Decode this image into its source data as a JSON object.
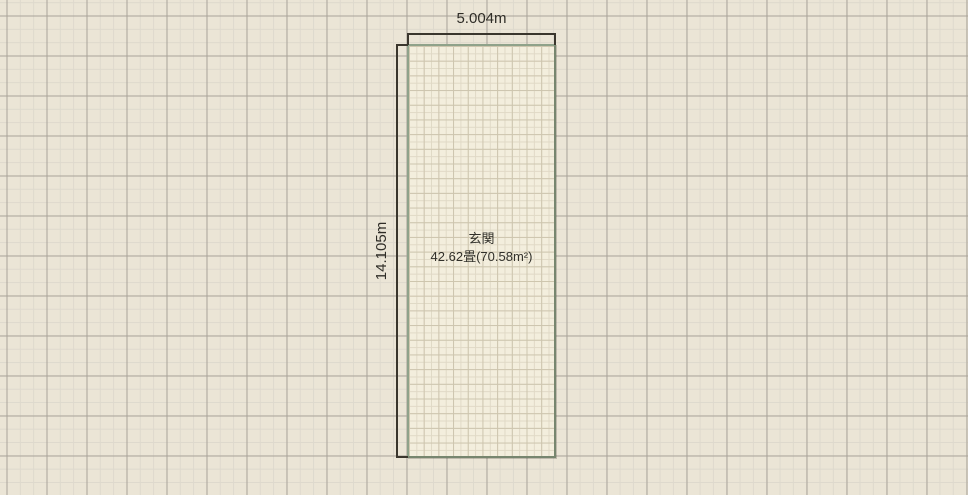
{
  "canvas": {
    "background_color": "#ebe5d6",
    "grid_major_color": "#a9a399",
    "grid_minor_color": "#ded9cd"
  },
  "room": {
    "name": "玄関",
    "area_label": "42.62畳(70.58m²)",
    "width_label": "5.004m",
    "height_label": "14.105m",
    "fill_color": "#f3eedd",
    "border_color": "#8fa28a",
    "fine_grid_color": "#cdc5ae"
  },
  "dimensions": {
    "line_color": "#3a362d",
    "text_color": "#2f2d27"
  }
}
